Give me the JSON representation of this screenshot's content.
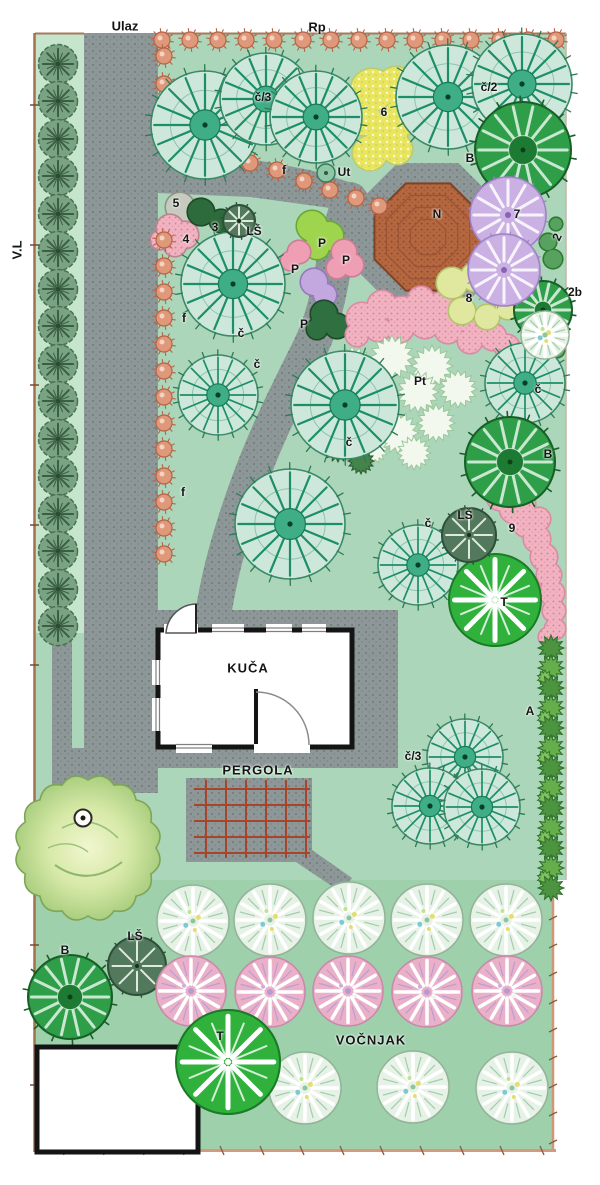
{
  "plan": {
    "outer": {
      "entrance": "Ulaz",
      "top_road": "Rp",
      "left_road": "V.L"
    },
    "areas": {
      "house": "KUČA",
      "pergola": "PERGOLA",
      "orchard": "VOČNJAK"
    },
    "labels": [
      {
        "text": "č/3",
        "x": 263,
        "y": 97
      },
      {
        "text": "6",
        "x": 384,
        "y": 112
      },
      {
        "text": "č/2",
        "x": 489,
        "y": 87
      },
      {
        "text": "B",
        "x": 470,
        "y": 158
      },
      {
        "text": "Ut",
        "x": 344,
        "y": 172
      },
      {
        "text": "f",
        "x": 284,
        "y": 170
      },
      {
        "text": "N",
        "x": 437,
        "y": 214
      },
      {
        "text": "7",
        "x": 517,
        "y": 214
      },
      {
        "text": "2",
        "x": 557,
        "y": 237,
        "rot": -65
      },
      {
        "text": "2b",
        "x": 575,
        "y": 292
      },
      {
        "text": "8",
        "x": 469,
        "y": 298
      },
      {
        "text": "5",
        "x": 176,
        "y": 203
      },
      {
        "text": "4",
        "x": 186,
        "y": 239
      },
      {
        "text": "3",
        "x": 215,
        "y": 227
      },
      {
        "text": "LŠ",
        "x": 254,
        "y": 231
      },
      {
        "text": "P",
        "x": 322,
        "y": 243
      },
      {
        "text": "P",
        "x": 346,
        "y": 260
      },
      {
        "text": "P",
        "x": 295,
        "y": 269
      },
      {
        "text": "P",
        "x": 304,
        "y": 324
      },
      {
        "text": "f",
        "x": 184,
        "y": 318
      },
      {
        "text": "f",
        "x": 183,
        "y": 492
      },
      {
        "text": "č",
        "x": 241,
        "y": 333
      },
      {
        "text": "č",
        "x": 257,
        "y": 364
      },
      {
        "text": "č",
        "x": 349,
        "y": 442
      },
      {
        "text": "Pt",
        "x": 420,
        "y": 381
      },
      {
        "text": "č",
        "x": 538,
        "y": 389
      },
      {
        "text": "B",
        "x": 548,
        "y": 454
      },
      {
        "text": "č",
        "x": 428,
        "y": 523
      },
      {
        "text": "LŠ",
        "x": 465,
        "y": 515
      },
      {
        "text": "9",
        "x": 512,
        "y": 528
      },
      {
        "text": "T",
        "x": 504,
        "y": 602
      },
      {
        "text": "A",
        "x": 530,
        "y": 711
      },
      {
        "text": "č/3",
        "x": 413,
        "y": 756
      },
      {
        "text": "O",
        "x": 83,
        "y": 818,
        "marker": true
      },
      {
        "text": "B",
        "x": 65,
        "y": 950
      },
      {
        "text": "LŠ",
        "x": 135,
        "y": 936
      },
      {
        "text": "T",
        "x": 220,
        "y": 1036
      }
    ]
  },
  "palette": {
    "lawn_green": "#abd6b9",
    "left_strip_green": "#c6e5cd",
    "orchard_green": "#9dd0ab",
    "path_gray": "#8d9797",
    "gazebo_brick": "#b5673f",
    "pergola_wood": "#a8442a",
    "coral_hedge": "#df9879",
    "teal_tree": "#1d8f68",
    "dark_tree_green": "#2f9e49",
    "lilac_tree": "#cbb0e4",
    "bright_tree_green": "#2fb13c",
    "pink_flowerbed": "#f2b3c1",
    "border_tan": "#a5704f",
    "house_wall": "#141414"
  }
}
